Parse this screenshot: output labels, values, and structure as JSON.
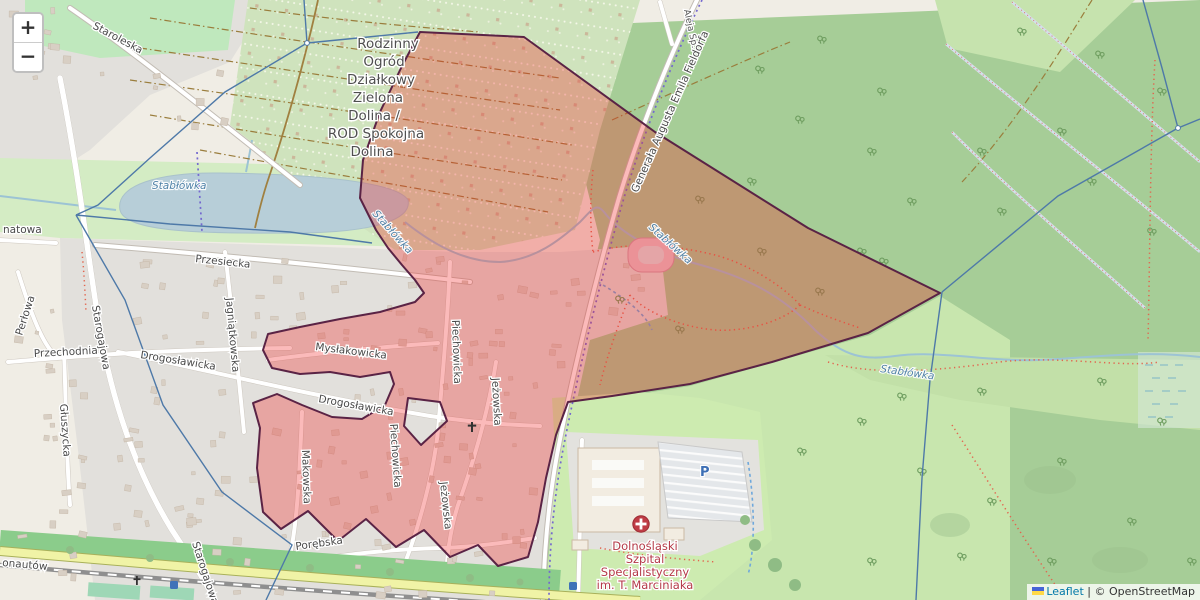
{
  "controls": {
    "zoom_in": "+",
    "zoom_out": "−"
  },
  "attribution": {
    "leaflet": "Leaflet",
    "separator": "|",
    "copyright": "© OpenStreetMap"
  },
  "area_label": {
    "lines": [
      "Rodzinny",
      "Ogród",
      "Działkowy",
      "Zielona",
      "Dolina /",
      "ROD Spokojna",
      "Dolina"
    ]
  },
  "hospital": {
    "lines": [
      "Dolnośląski",
      "Szpital",
      "Specjalistyczny",
      "im. T. Marciniaka"
    ],
    "parking": "P"
  },
  "water": {
    "pond": "Stabłówka",
    "stream": "Stabłówka"
  },
  "streets": {
    "staroleska": "Staroleska",
    "starogajowa": "Starogajowa",
    "natowa": "natowa",
    "perlowa": "Perłowa",
    "przechodnia": "Przechodnia",
    "gluszycka": "Głuszycka",
    "przesiecka": "Przesiecka",
    "jagniatkowska": "Jagniątkowska",
    "drogoslawicka": "Drogosławicka",
    "myslakowicka": "Mysłakowicka",
    "piechowicka": "Piechowicka",
    "jezowska": "Jeżowska",
    "makowska": "Makowska",
    "porebska": "Porębska",
    "kosmonautow": "onautów",
    "fieldorfa": "Generała Augusta Emila Fieldorfa",
    "aleja": "Aleja Sp."
  },
  "colors": {
    "overlay_fill": "rgba(244,40,40,0.32)",
    "overlay_stroke": "#5a2345",
    "forest": "#a6cd97",
    "meadow": "#c8e6ae",
    "residential": "#e2e0dc",
    "water": "#b7ced8",
    "boundary": "#4e79a8"
  }
}
